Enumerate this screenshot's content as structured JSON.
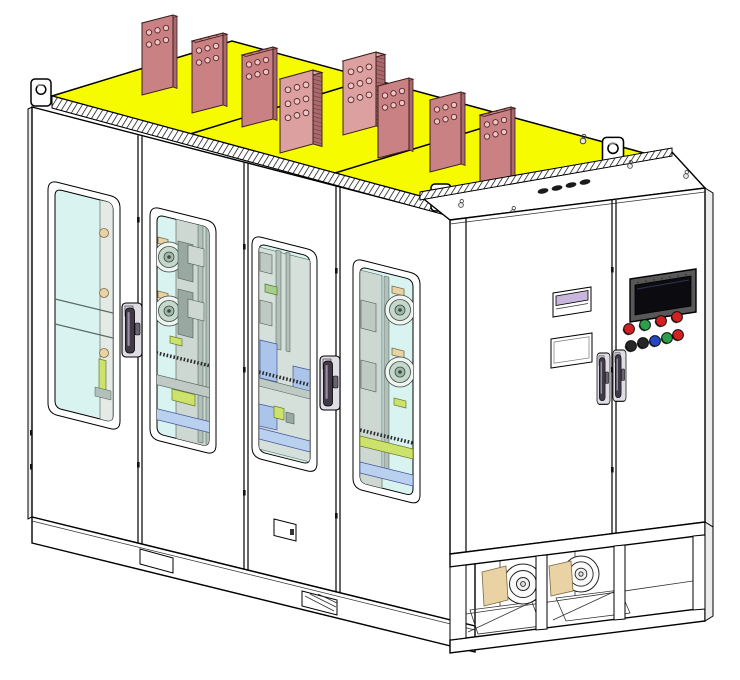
{
  "window": {
    "width": 740,
    "height": 680
  },
  "colors": {
    "outline": "#000000",
    "white": "#ffffff",
    "shade": "#ececec",
    "roof": "#f7fb00",
    "busbar_face": "#c98184",
    "busbar_face_light": "#dda0a0",
    "busbar_top": "#e7b2b2",
    "busbar_side": "#a96a6d",
    "busbar_hole": "#ecc6c6",
    "glass": "#d9f3f1",
    "mach_panel": "#cdd8d2",
    "mach_gray": "#c0cac4",
    "mach_rail": "#b2c0ba",
    "yg": "#cde26a",
    "lblue": "#aac4ea",
    "lblue2": "#b9d0ee",
    "tan": "#e9d2a4",
    "handle_dark": "#3f3a46",
    "handle_light": "#e0dde4",
    "handle_hi": "#9a8ea6",
    "bezel": "#585858",
    "screen": "#0c0c10",
    "lavender": "#c9b6dd",
    "slot": "#1a1a1a"
  },
  "panel": {
    "buttons_row1": [
      "#d42020",
      "#2aa04a",
      "#d42020",
      "#d42020"
    ],
    "buttons_row2": [
      "#262626",
      "#262626",
      "#2347c5",
      "#2aa04a",
      "#d42020"
    ]
  },
  "structure": {
    "busbar_count": 8,
    "busbar_hole_counts": [
      6,
      6,
      6,
      9,
      9,
      6,
      6,
      6
    ],
    "main_door_count": 4,
    "main_window_count": 4,
    "end_door_count": 2,
    "lifting_lug_count": 3,
    "top_slot_count": 4,
    "base_fan_count": 2,
    "pushbutton_count": 9,
    "eyebolt_count": 5
  }
}
